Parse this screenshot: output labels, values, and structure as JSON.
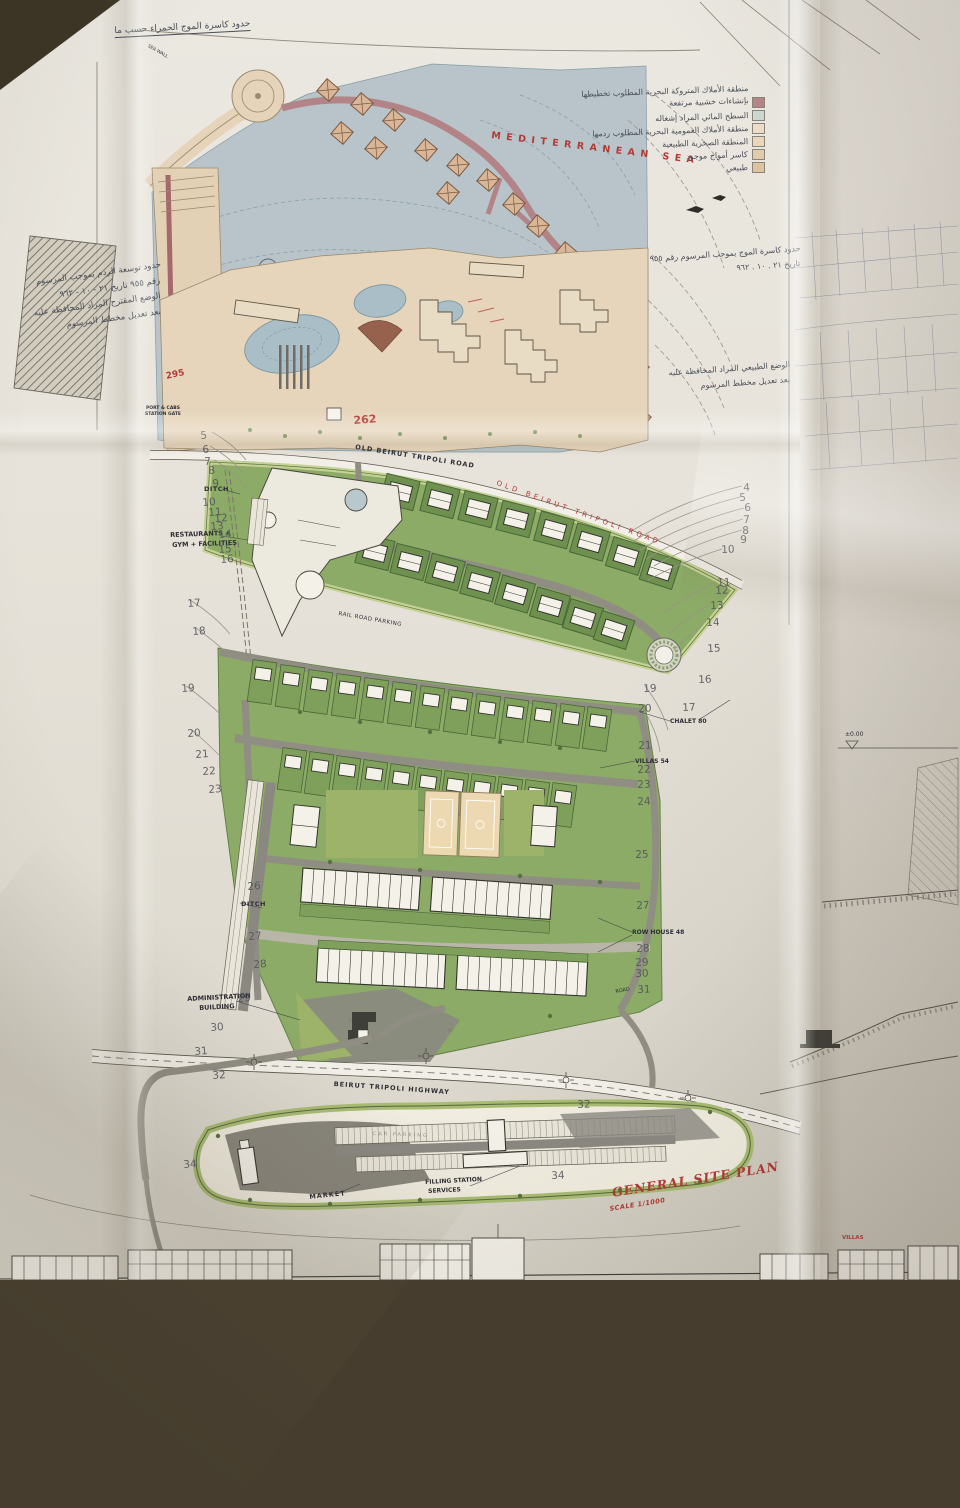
{
  "title_block": {
    "title": "GENERAL SITE PLAN",
    "scale": "SCALE 1/1000"
  },
  "colors": {
    "accent_red": "#b23a36",
    "sea_blue": "#b6c3c8",
    "plot_green": "#6f9150",
    "band_green": "#c6d295",
    "resort_tan": "#e6d5bb",
    "pier_mauve": "#b28487",
    "paper": "#e8e4db"
  },
  "labels": [
    {
      "name": "sea-name-label",
      "t": "MEDITERRANEAN SEA",
      "x": 492,
      "y": 130,
      "s": 9.5,
      "r": 7,
      "ls": 5.5,
      "cls": "red bold"
    },
    {
      "name": "old-road-label",
      "t": "OLD BEIRUT TRIPOLI ROAD",
      "x": 356,
      "y": 443,
      "s": 6.5,
      "r": 9,
      "ls": 1,
      "cls": "bold"
    },
    {
      "name": "old-road-red-label",
      "t": "OLD BEIRUT TRIPOLI ROAD",
      "x": 498,
      "y": 479,
      "s": 7,
      "r": 20,
      "ls": 3.5,
      "cls": "red"
    },
    {
      "name": "parcel-number-262",
      "t": "262",
      "x": 353,
      "y": 414,
      "s": 11,
      "r": -4,
      "cls": "red bold"
    },
    {
      "name": "parcel-number-295",
      "t": "295",
      "x": 165,
      "y": 372,
      "s": 9,
      "r": -12,
      "cls": "red bold"
    },
    {
      "name": "ditch-label-north",
      "t": "DITCH",
      "x": 204,
      "y": 485,
      "s": 6.5,
      "ls": 0.5,
      "cls": "bold"
    },
    {
      "name": "ditch-label-south",
      "t": "DITCH",
      "x": 241,
      "y": 900,
      "s": 6.5,
      "ls": 0.5,
      "cls": "bold"
    },
    {
      "name": "restaurants-label-line1",
      "t": "RESTAURANTS +",
      "x": 170,
      "y": 531,
      "s": 6.5,
      "r": -2,
      "cls": "bold"
    },
    {
      "name": "restaurants-label-line2",
      "t": "GYM + FACILITIES",
      "x": 172,
      "y": 541,
      "s": 6.5,
      "r": -2,
      "cls": "bold"
    },
    {
      "name": "rail-road-parking-label",
      "t": "RAIL ROAD PARKING",
      "x": 339,
      "y": 611,
      "s": 5.5,
      "r": 10,
      "ls": 0.5,
      "cls": ""
    },
    {
      "name": "chalet-80-label",
      "t": "CHALET 80",
      "x": 670,
      "y": 718,
      "s": 6,
      "cls": "bold"
    },
    {
      "name": "villas-54-label",
      "t": "VILLAS 54",
      "x": 635,
      "y": 758,
      "s": 6,
      "cls": "bold"
    },
    {
      "name": "row-house-48-label",
      "t": "ROW HOUSE 48",
      "x": 632,
      "y": 929,
      "s": 6,
      "cls": "bold"
    },
    {
      "name": "road-label-small",
      "t": "ROAD",
      "x": 615,
      "y": 989,
      "s": 5,
      "r": -10,
      "cls": ""
    },
    {
      "name": "administration-label-line1",
      "t": "ADMINISTRATION",
      "x": 187,
      "y": 995,
      "s": 6.5,
      "r": -3,
      "cls": "bold"
    },
    {
      "name": "administration-label-line2",
      "t": "BUILDING",
      "x": 199,
      "y": 1004,
      "s": 6.5,
      "r": -3,
      "cls": "bold"
    },
    {
      "name": "highway-label",
      "t": "BEIRUT TRIPOLI HIGHWAY",
      "x": 334,
      "y": 1080,
      "s": 6.5,
      "r": 4,
      "ls": 1,
      "cls": "bold"
    },
    {
      "name": "market-label",
      "t": "MARKET",
      "x": 309,
      "y": 1193,
      "s": 6.5,
      "r": -6,
      "ls": 1,
      "cls": "bold"
    },
    {
      "name": "filling-station-label-line1",
      "t": "FILLING STATION",
      "x": 425,
      "y": 1179,
      "s": 6,
      "r": -3,
      "cls": "bold"
    },
    {
      "name": "filling-station-label-line2",
      "t": "SERVICES",
      "x": 428,
      "y": 1188,
      "s": 6,
      "r": -3,
      "cls": "bold"
    },
    {
      "name": "car-parking-label",
      "t": "CAR PARKING",
      "x": 373,
      "y": 1131,
      "s": 5,
      "r": 2,
      "ls": 2,
      "cls": "faint"
    },
    {
      "name": "port-cabs-label-line1",
      "t": "PORT & CABS",
      "x": 146,
      "y": 406,
      "s": 4.5,
      "cls": "bold"
    },
    {
      "name": "port-cabs-label-line2",
      "t": "STATION GATE",
      "x": 145,
      "y": 412,
      "s": 4.5,
      "cls": "bold"
    },
    {
      "name": "sea-wall-label",
      "t": "SEA WALL",
      "x": 149,
      "y": 44,
      "s": 4.5,
      "r": 30,
      "cls": ""
    },
    {
      "name": "level-label",
      "t": "±0.00",
      "x": 845,
      "y": 731,
      "s": 6,
      "cls": ""
    },
    {
      "name": "villas-elevation-label",
      "t": "VILLAS",
      "x": 842,
      "y": 1235,
      "s": 5.5,
      "cls": "red bold"
    }
  ],
  "title_pos": {
    "x": 611,
    "y": 1185,
    "r": -9,
    "s": 12.5
  },
  "scale_pos": {
    "x": 609,
    "y": 1205,
    "r": -9,
    "s": 6.5
  },
  "contour_numbers": {
    "left": [
      [
        5,
        200,
        430
      ],
      [
        6,
        202,
        444
      ],
      [
        7,
        204,
        456
      ],
      [
        8,
        208,
        465
      ],
      [
        9,
        212,
        478
      ],
      [
        10,
        202,
        497
      ],
      [
        11,
        208,
        507
      ],
      [
        12,
        214,
        513
      ],
      [
        13,
        210,
        521
      ],
      [
        14,
        218,
        529
      ],
      [
        15,
        218,
        544
      ],
      [
        16,
        220,
        554
      ],
      [
        17,
        187,
        598
      ],
      [
        18,
        192,
        626
      ],
      [
        19,
        181,
        683
      ],
      [
        20,
        187,
        728
      ],
      [
        21,
        195,
        749
      ],
      [
        22,
        202,
        766
      ],
      [
        23,
        208,
        784
      ],
      [
        26,
        247,
        881
      ],
      [
        27,
        248,
        931
      ],
      [
        28,
        253,
        959
      ],
      [
        29,
        237,
        993
      ],
      [
        30,
        210,
        1022
      ],
      [
        31,
        194,
        1046
      ],
      [
        32,
        212,
        1070
      ],
      [
        34,
        183,
        1159
      ]
    ],
    "right": [
      [
        4,
        743,
        482
      ],
      [
        5,
        739,
        492
      ],
      [
        6,
        744,
        502
      ],
      [
        7,
        743,
        514
      ],
      [
        8,
        742,
        525
      ],
      [
        9,
        740,
        534
      ],
      [
        10,
        721,
        544
      ],
      [
        11,
        717,
        577
      ],
      [
        12,
        715,
        585
      ],
      [
        13,
        710,
        600
      ],
      [
        14,
        706,
        617
      ],
      [
        15,
        707,
        643
      ],
      [
        16,
        698,
        674
      ],
      [
        17,
        682,
        702
      ],
      [
        19,
        643,
        683
      ],
      [
        20,
        638,
        703
      ],
      [
        21,
        638,
        740
      ],
      [
        22,
        637,
        764
      ],
      [
        23,
        637,
        779
      ],
      [
        24,
        637,
        796
      ],
      [
        25,
        635,
        849
      ],
      [
        27,
        636,
        900
      ],
      [
        28,
        636,
        943
      ],
      [
        29,
        635,
        957
      ],
      [
        30,
        635,
        968
      ],
      [
        31,
        637,
        984
      ],
      [
        32,
        577,
        1099
      ],
      [
        34,
        551,
        1170
      ]
    ]
  },
  "annotations": {
    "top_left": {
      "x": 250,
      "y": 19,
      "r": -3,
      "s": 9,
      "underline": true,
      "lines": [
        "حدود كاسرة الموج الحمراء حسب ما"
      ]
    },
    "left_block": {
      "x": 160,
      "y": 260,
      "r": -8,
      "s": 8.5,
      "lines": [
        "حدود توسعة الردم بموجب المرسوم",
        "رقم ٩٥٥ تاريخ ٢١ - ١٠ - ٩٦٢",
        "الوضع المقترح المراد المحافظة عليه",
        "بعد تعديل مخطط المرسوم"
      ]
    },
    "right_block_a": {
      "x": 800,
      "y": 244,
      "r": -4,
      "s": 8,
      "lines": [
        "حدود كاسرة الموج بموجب المرسوم رقم ٩٥٥",
        "تاريخ ٢١ . ١٠ . ٩٦٢"
      ]
    },
    "right_block_b": {
      "x": 790,
      "y": 360,
      "r": -4,
      "s": 8,
      "lines": [
        "الوضع الطبيعي المراد المحافظة عليه",
        "بعد تعديل مخطط المرسوم"
      ]
    }
  },
  "legend": {
    "text_right_px": 212,
    "rotation": -2,
    "lines": [
      {
        "text": "منطقة الأملاك المتروكة البحرية المطلوب تخطيطها",
        "y": 84
      },
      {
        "text": "بإنشاءات خشبية مرتفعة",
        "y": 96
      },
      {
        "text": "السطح المائي المراد إشغاله",
        "y": 111
      },
      {
        "text": "منطقة الأملاك العمومية البحرية المطلوب ردمها",
        "y": 124
      },
      {
        "text": "المنطقة الصخرية الطبيعية",
        "y": 137
      },
      {
        "text": "كاسر أمواج موجود",
        "y": 150
      },
      {
        "text": "طبيعي",
        "y": 163
      }
    ],
    "swatches": [
      {
        "color": "#b5848a",
        "y": 97
      },
      {
        "color": "#ccd9d3",
        "y": 110
      },
      {
        "color": "#ecdccb",
        "y": 123
      },
      {
        "color": "#e9d6bd",
        "y": 136
      },
      {
        "color": "#e2cbab",
        "y": 149
      },
      {
        "color": "#dcc49f",
        "y": 162
      }
    ]
  }
}
